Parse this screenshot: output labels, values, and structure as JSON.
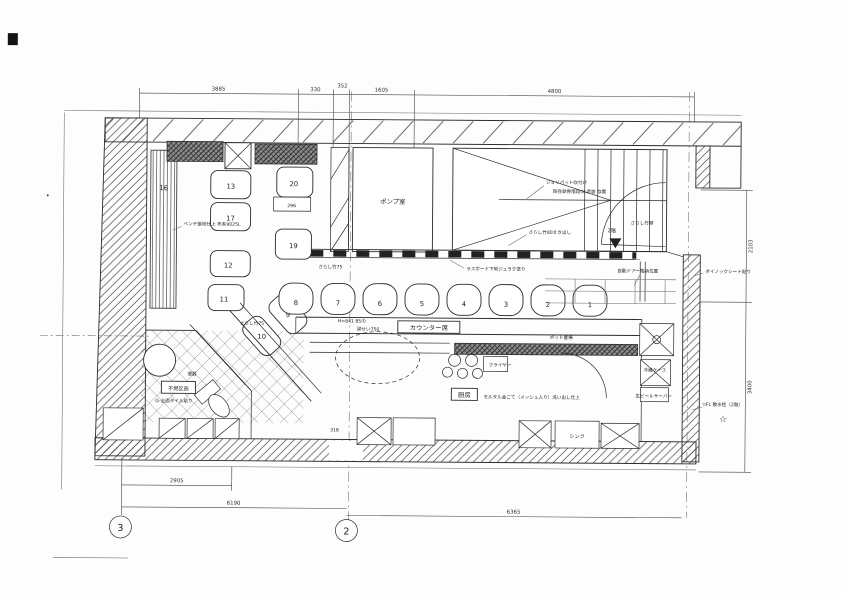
{
  "drawing": {
    "grid_bubbles": [
      "3",
      "2"
    ],
    "dims": {
      "top": [
        "3885",
        "330",
        "352",
        "1605",
        "4800"
      ],
      "right": [
        "2103",
        "3400"
      ],
      "bottom": [
        "2905",
        "6190",
        "6365"
      ],
      "inner": {
        "table": "296",
        "sink_w": "318"
      }
    },
    "rooms": {
      "pump_room": "ポンプ室",
      "kitchen": "厨房",
      "counter_seats": "カウンター席",
      "fire_box": "不燃区画"
    },
    "labels": {
      "jolypate": "ジョリパット吹付け",
      "stair_note": "既存鉄骨階段GL塗装 存置",
      "bamboo_fence": "さらし竹塀",
      "bamboo80": "さらし竹80まき出し",
      "bamboo75": "さらし竹75",
      "bamboo75b": "さらし竹75",
      "lath": "ラスボード下地ジュラク塗り",
      "auto_door": "自動ドアー格納位置",
      "dinoc": "ダイノックシート貼り",
      "bench": "ベンチ張地仕上 布系9025L",
      "h841": "H=841 85巾",
      "beam750": "梁せい750",
      "fryer": "フライヤー",
      "mortar": "モルタル金ごて（メッシュ入り）洗い出し仕上",
      "sink": "シンク",
      "pot": "ポット置場",
      "fridge": "冷蔵ケース",
      "beer": "生ビールサーバー",
      "toilet": "便器",
      "tile": "G-全面タイル貼り",
      "floor2": "2階",
      "sprinkler": "▽FL 散水栓（2階）",
      "star": "☆"
    },
    "seats": {
      "booth": [
        "13",
        "17",
        "12",
        "11",
        "20",
        "19",
        "9",
        "10",
        "16"
      ],
      "counter": [
        "8",
        "7",
        "6",
        "5",
        "4",
        "3",
        "2",
        "1"
      ]
    }
  }
}
